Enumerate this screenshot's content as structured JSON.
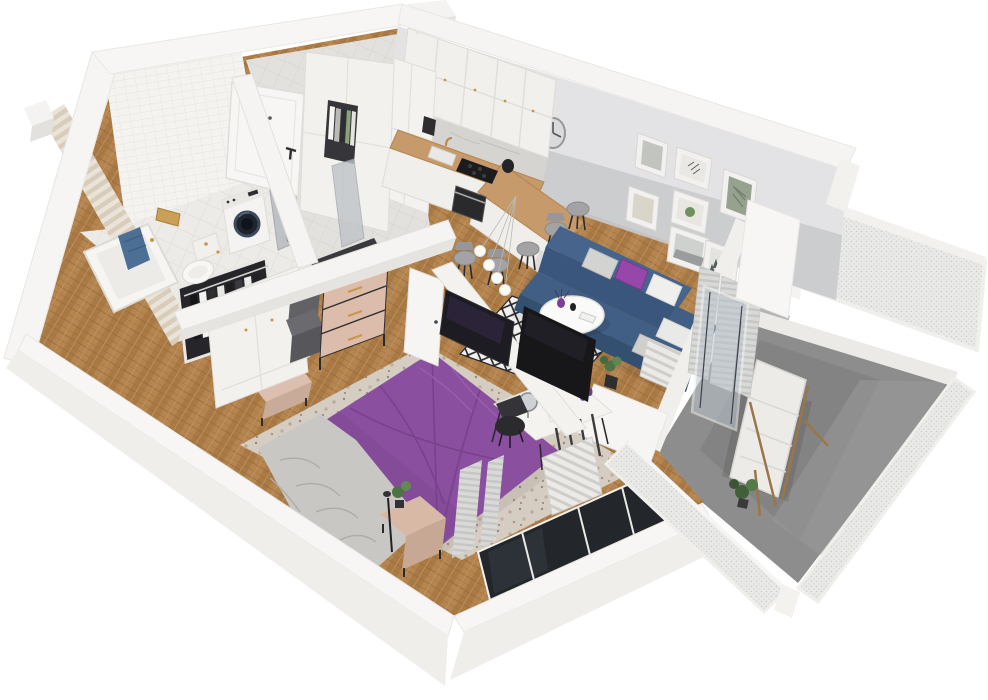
{
  "scene": {
    "title": "isometric-3d-apartment-floor-plan-render",
    "view": "cutaway top-down isometric, walls cut at height, no text labels",
    "background": "#ffffff",
    "palette": {
      "wall_white": "#f6f5f3",
      "wall_face_shadow": "#efeeeb",
      "accent_wall_gray": "#c9cacc",
      "wood_floor": "#b5854f",
      "bathroom_tile": "#f3f2ef",
      "hall_tile": "#e3e1dd",
      "balcony_concrete": "#8d8d8d",
      "mesh_railing": "#e8e8e6",
      "sofa_navy": "#3f5c80",
      "bed_purple": "#8a4f9e",
      "pillow_purple": "#9747a9",
      "dresser_blush": "#dcbcab",
      "towel_blue": "#4c6f96",
      "brass": "#c9964b",
      "counter_wood": "#c69a6a",
      "tv_black": "#1d1c22",
      "plant_green": "#4d7344"
    },
    "rooms": [
      {
        "name": "bathroom",
        "position": "top-left",
        "items": [
          "white-tiled-wall",
          "tiled-floor",
          "bathtub",
          "blue-towel",
          "wall-hung-toilet",
          "washing-machine",
          "brass-mirror",
          "frosted-sliding-door-panels"
        ]
      },
      {
        "name": "hallway",
        "position": "top-center-left",
        "items": [
          "entrance-door-with-black-handle",
          "tall-white-wardrobe",
          "open-bookshelf-niche",
          "gray-tile-floor"
        ]
      },
      {
        "name": "kitchen",
        "position": "top-center",
        "items": [
          "white-upper-cabinets",
          "tall-cabinet-column",
          "marble-backsplash",
          "wood-countertop",
          "sink-with-brass-faucet",
          "black-cooktop",
          "built-in-oven",
          "coffee-maker",
          "black-kettle",
          "l-shaped-breakfast-bar",
          "five-gray-bar-stools",
          "globe-pendant-lamp",
          "round-wall-clock"
        ]
      },
      {
        "name": "living-room",
        "position": "right-of-center",
        "items": [
          "gray-accent-wall",
          "gallery-wall-seven-framed-prints",
          "navy-corner-sofa",
          "gray-white-and-purple-cushions",
          "round-white-coffee-table",
          "purple-vase-and-decor",
          "black-white-diamond-rug",
          "potted-plant",
          "radiator",
          "gray-curtains",
          "open-glass-balcony-door"
        ]
      },
      {
        "name": "bedroom",
        "position": "bottom-center",
        "items": [
          "double-bed-purple-duvet",
          "crumpled-gray-throw",
          "speckled-area-rug",
          "blush-bench-at-headboard",
          "wood-nightstand-with-plant",
          "black-floor-lamp",
          "open-clothes-rack-with-hanging-garments",
          "white-paneled-wardrobe",
          "two-gray-storage-boxes",
          "blush-dresser-black-top-brass-handles",
          "tv-partition-wall-with-two-screens",
          "white-vanity-desk",
          "round-mirror",
          "black-desk-chair",
          "radiator",
          "curtains",
          "big-window-in-south-wall",
          "open-white-door"
        ]
      },
      {
        "name": "balcony",
        "position": "right",
        "items": [
          "gray-concrete-floor",
          "perforated-mesh-railing-panels",
          "white-railing-posts",
          "wooden-deck-lounger-with-white-cushion",
          "potted-plant"
        ]
      }
    ]
  }
}
